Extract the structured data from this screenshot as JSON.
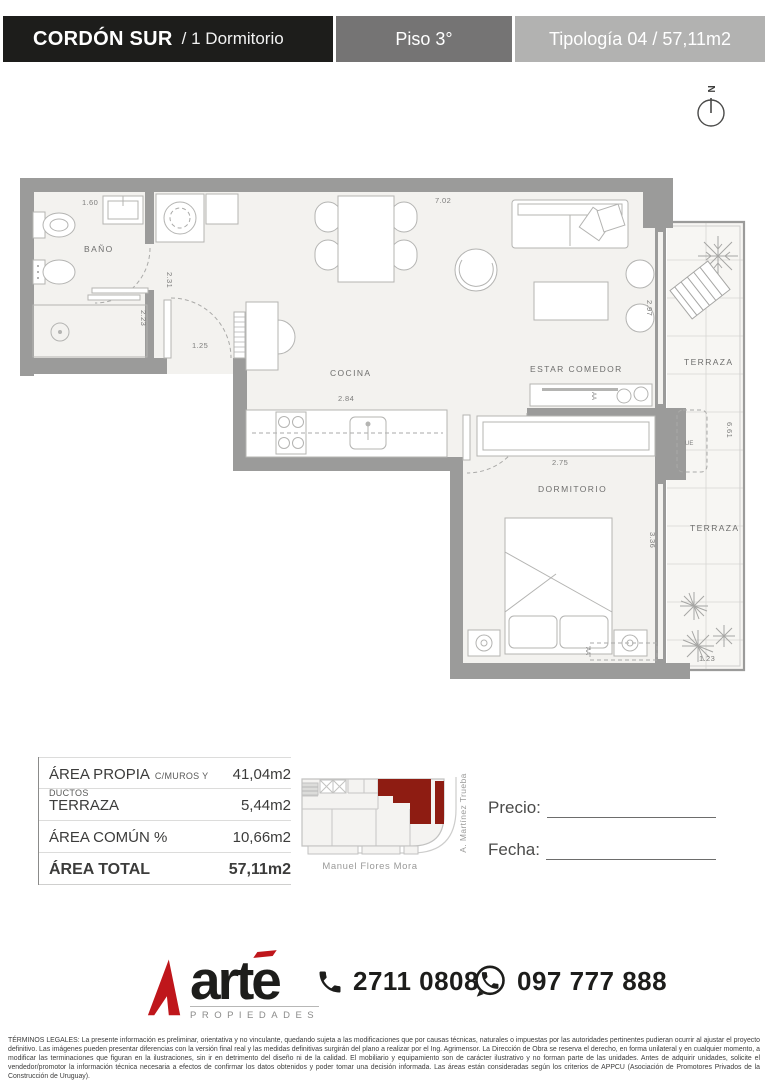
{
  "header": {
    "project": "CORDÓN SUR",
    "unit": "/ 1 Dormitorio",
    "floor": "Piso 3°",
    "typology": "Tipología 04 / 57,11m2"
  },
  "compass": {
    "north": "N"
  },
  "floor_plan": {
    "rooms": {
      "bathroom": "BAÑO",
      "kitchen": "COCINA",
      "living": "ESTAR COMEDOR",
      "bedroom": "DORMITORIO",
      "terrace_upper": "TERRAZA",
      "terrace_lower": "TERRAZA"
    },
    "equipment": {
      "exterior_unit": "UE",
      "ac_living": "AA",
      "ac_bedroom": "AA"
    },
    "dimensions": {
      "bath_width": "1.60",
      "bath_depth": "2.31",
      "bath_lower": "2.23",
      "entry": "1.25",
      "living_length": "7.02",
      "kitchen_width": "2.84",
      "living_width": "2.97",
      "closet_width": "2.75",
      "bedroom_depth": "3.36",
      "terrace_height": "6.61",
      "terrace_width": "1.23"
    }
  },
  "area_table": {
    "rows": [
      {
        "label": "ÁREA PROPIA",
        "sublabel": "C/MUROS Y DUCTOS",
        "value": "41,04m2"
      },
      {
        "label": "TERRAZA",
        "sublabel": "",
        "value": "5,44m2"
      },
      {
        "label": "ÁREA COMÚN %",
        "sublabel": "",
        "value": "10,66m2"
      },
      {
        "label": "ÁREA TOTAL",
        "sublabel": "",
        "value": "57,11m2"
      }
    ]
  },
  "location_map": {
    "street_bottom": "Manuel Flores Mora",
    "street_right": "A. Martínez Trueba"
  },
  "form": {
    "price_label": "Precio:",
    "date_label": "Fecha:"
  },
  "footer": {
    "brand": "arte",
    "brand_sub": "PROPIEDADES",
    "phone": "2711 0808",
    "whatsapp": "097 777 888"
  },
  "legal": {
    "text": "TÉRMINOS LEGALES: La presente información es preliminar, orientativa y no vinculante, quedando sujeta a las modificaciones que por causas técnicas, naturales o impuestas por las autoridades pertinentes pudieran ocurrir al ajustar el proyecto definitivo. Las imágenes pueden presentar diferencias con la versión final real y las medidas definitivas surgirán del plano a realizar por el Ing. Agrimensor. La Dirección de Obra se reserva el derecho, en forma unilateral y en cualquier momento, a modificar las terminaciones que figuran en la ilustraciones, sin ir en detrimento del diseño ni de la calidad. El mobiliario y equipamiento son de carácter ilustrativo y no forman parte de las unidades. Antes de adquirir unidades, solicite el vendedor/promotor la información técnica necesaria a efectos de confirmar los datos obtenidos y poder tomar una decisión informada. Las áreas están consideradas según los criterios de APPCU (Asociación de Promotores Privados de la Construcción de Uruguay)."
  },
  "colors": {
    "header_black": "#1d1d1b",
    "header_gray": "#757474",
    "header_light_gray": "#b2b2b1",
    "wall_gray": "#9b9b9a",
    "brand_red": "#bf161b",
    "map_unit_red": "#8e1c12"
  }
}
